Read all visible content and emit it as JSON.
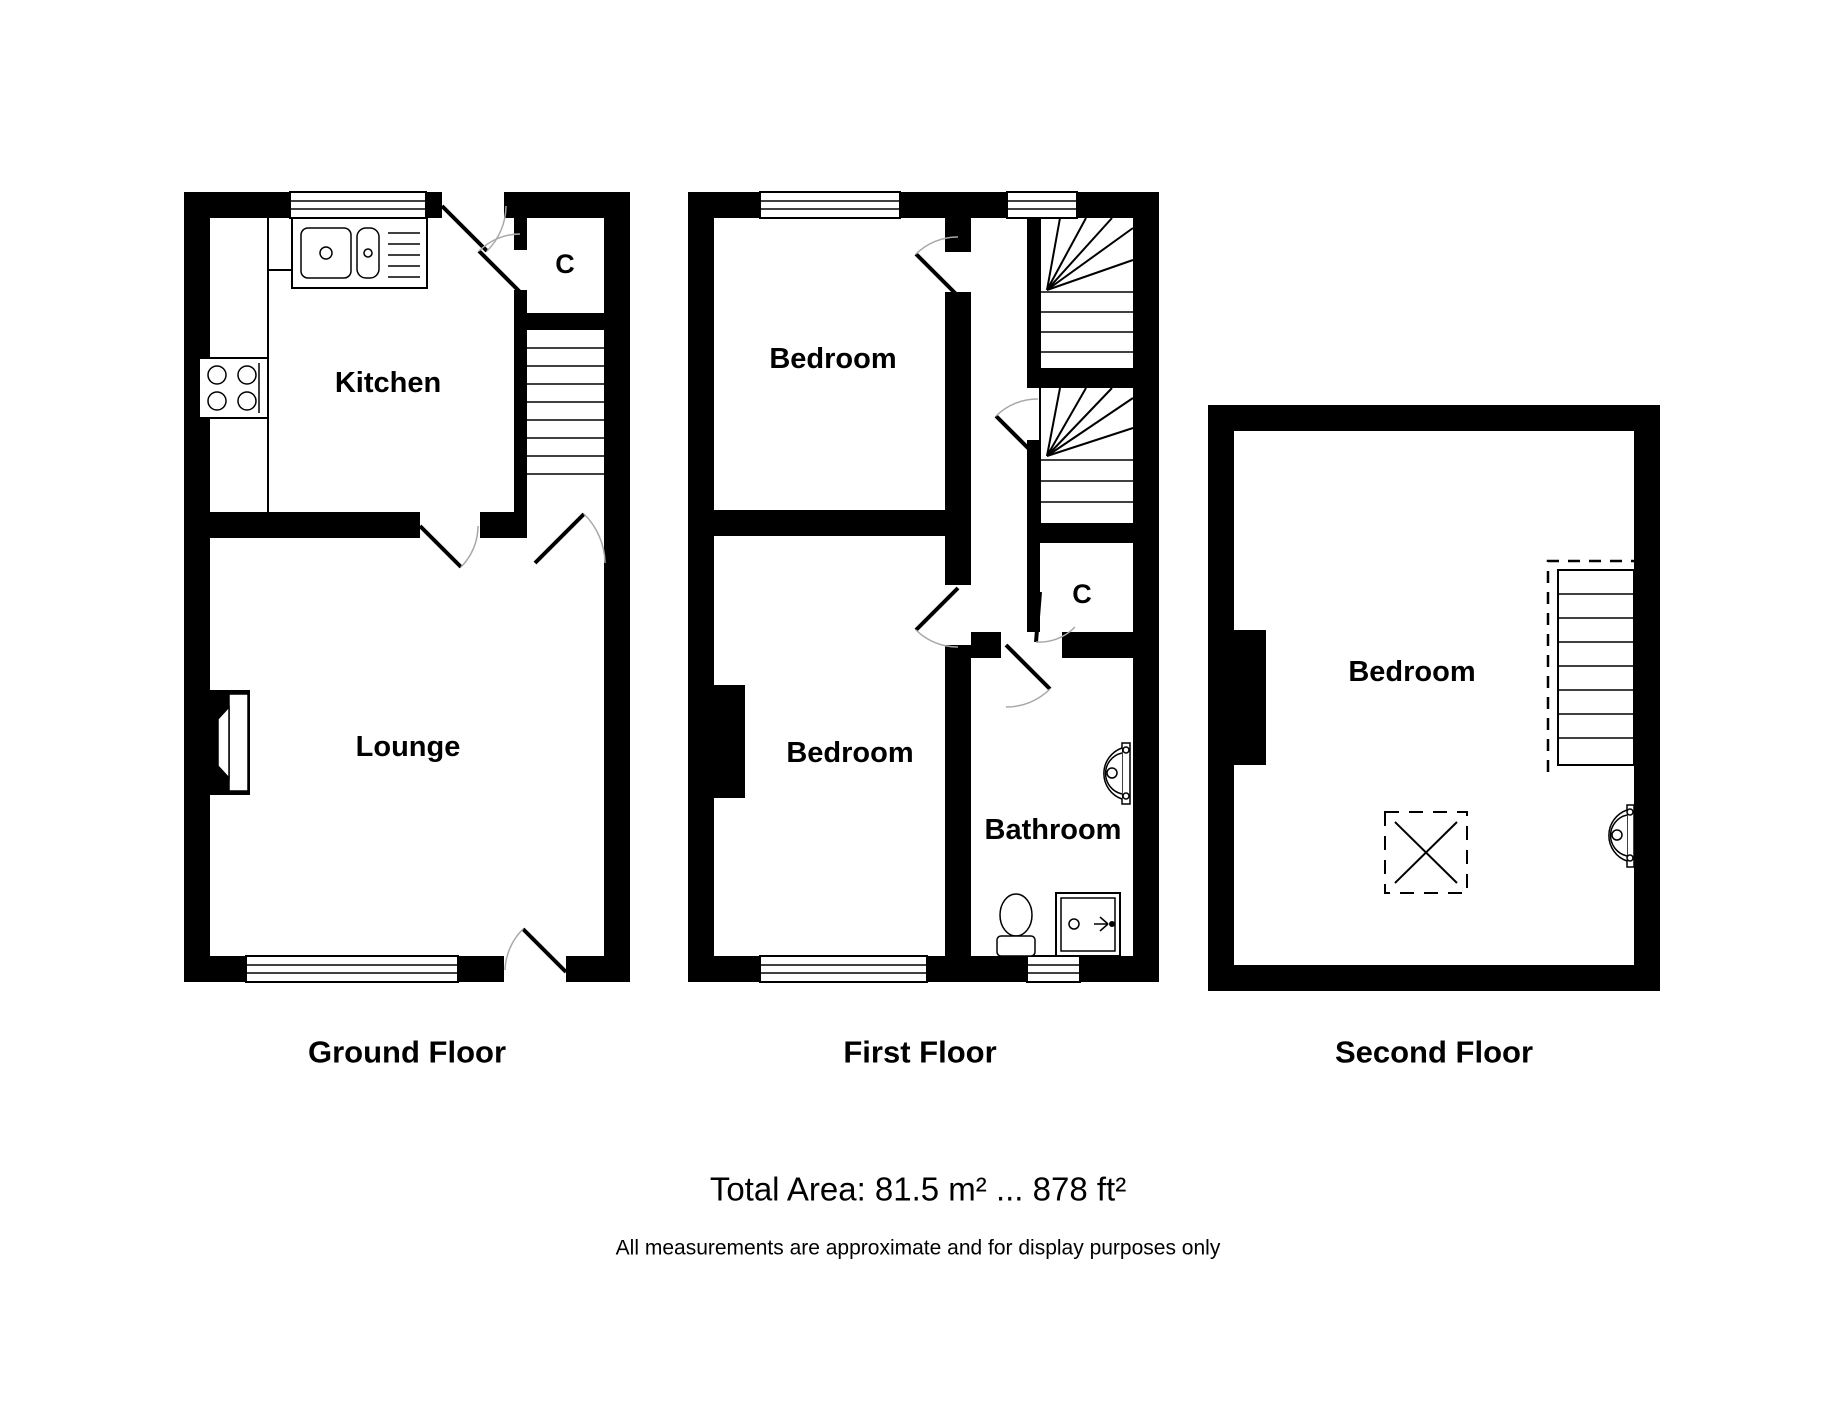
{
  "floors": [
    {
      "label": "Ground Floor",
      "rooms": {
        "kitchen": "Kitchen",
        "lounge": "Lounge",
        "closet": "C"
      }
    },
    {
      "label": "First Floor",
      "rooms": {
        "bedroom_front": "Bedroom",
        "bedroom_back": "Bedroom",
        "bathroom": "Bathroom",
        "closet": "C"
      }
    },
    {
      "label": "Second Floor",
      "rooms": {
        "bedroom": "Bedroom"
      }
    }
  ],
  "footer": {
    "total_area": "Total Area: 81.5 m² ... 878 ft²",
    "disclaimer": "All measurements are approximate and for display purposes only"
  },
  "colors": {
    "wall": "#000000",
    "background": "#ffffff",
    "door_arc": "#a8a8a8"
  }
}
